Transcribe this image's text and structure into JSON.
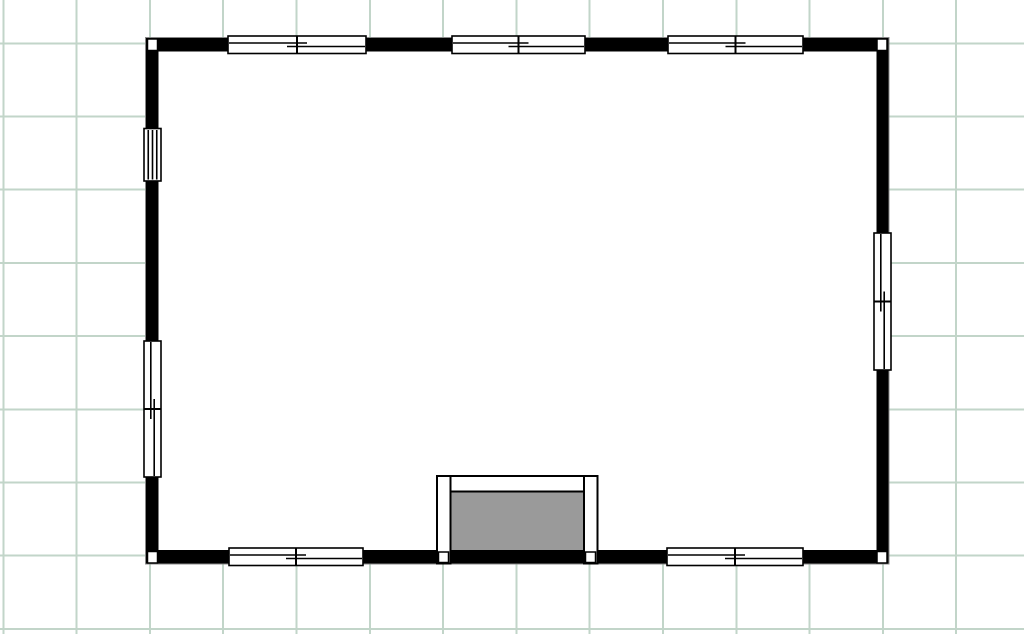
{
  "app": {
    "name": "floor-plan-editor",
    "view": "2d-plan"
  },
  "canvas": {
    "width": 1024,
    "height": 634,
    "background": "#ffffff"
  },
  "grid": {
    "visible": true,
    "color": "#c2d5c9",
    "line_width": 2,
    "spacing_x": 73.3,
    "spacing_y": 73.2,
    "offset_x": 3.3,
    "offset_y": 43.3
  },
  "colors": {
    "wall_fill": "#000000",
    "wall_outline": "#888888",
    "interior_fill": "#ffffff",
    "window_fill": "#ffffff",
    "window_stroke": "#000000",
    "fireplace_fill": "#9a9a9a",
    "fireplace_stroke": "#000000",
    "post_fill": "#ffffff",
    "post_stroke": "#000000"
  },
  "room": {
    "shape": "rectangle",
    "outer": {
      "x": 145.5,
      "y": 37.5,
      "w": 743.5,
      "h": 526.5
    },
    "inner": {
      "x": 158.5,
      "y": 51.5,
      "w": 718.0,
      "h": 498.5
    }
  },
  "corner_posts": [
    {
      "id": "corner-post-top-left",
      "x": 147.5,
      "y": 39.0,
      "w": 10,
      "h": 11.5
    },
    {
      "id": "corner-post-top-right",
      "x": 877.0,
      "y": 39.0,
      "w": 10,
      "h": 11.5
    },
    {
      "id": "corner-post-bottom-left",
      "x": 147.5,
      "y": 551.5,
      "w": 10,
      "h": 11.5
    },
    {
      "id": "corner-post-bottom-right",
      "x": 877.0,
      "y": 551.5,
      "w": 10,
      "h": 11.5
    }
  ],
  "windows": [
    {
      "id": "window-top-1",
      "wall": "top",
      "orientation": "h",
      "type": "double",
      "x": 228.0,
      "y": 36.0,
      "w": 138.0,
      "h": 17.5
    },
    {
      "id": "window-top-2",
      "wall": "top",
      "orientation": "h",
      "type": "double",
      "x": 452.0,
      "y": 36.0,
      "w": 133.0,
      "h": 17.5
    },
    {
      "id": "window-top-3",
      "wall": "top",
      "orientation": "h",
      "type": "double",
      "x": 668.0,
      "y": 36.0,
      "w": 135.0,
      "h": 17.5
    },
    {
      "id": "window-left-1",
      "wall": "left",
      "orientation": "v",
      "type": "single",
      "x": 144.0,
      "y": 128.5,
      "w": 17.0,
      "h": 52.5
    },
    {
      "id": "window-left-2",
      "wall": "left",
      "orientation": "v",
      "type": "double",
      "x": 144.0,
      "y": 341.0,
      "w": 17.0,
      "h": 136.0
    },
    {
      "id": "window-right-1",
      "wall": "right",
      "orientation": "v",
      "type": "double",
      "x": 874.0,
      "y": 233.0,
      "w": 17.0,
      "h": 137.0
    },
    {
      "id": "window-bottom-1",
      "wall": "bottom",
      "orientation": "h",
      "type": "double",
      "x": 229.0,
      "y": 548.0,
      "w": 134.0,
      "h": 17.5
    },
    {
      "id": "window-bottom-2",
      "wall": "bottom",
      "orientation": "h",
      "type": "double",
      "x": 667.0,
      "y": 548.0,
      "w": 136.0,
      "h": 17.5
    }
  ],
  "window_glyph": {
    "border_width": 1.6,
    "mullion_width": 2,
    "casement_width": 1.6,
    "casement_pos": 0.4,
    "overlap": 10,
    "single_line_fractions": [
      0.25,
      0.5,
      0.75
    ]
  },
  "fireplace": {
    "id": "fireplace",
    "firebox": {
      "x": 450.5,
      "y": 491.5,
      "w": 133.5,
      "h": 58.5
    },
    "top_band": {
      "x": 437.0,
      "y": 476.0,
      "w": 160.5,
      "h": 15.5
    },
    "left_column": {
      "x": 437.0,
      "y": 476.0,
      "w": 13.5,
      "h": 87.5
    },
    "right_column": {
      "x": 584.0,
      "y": 476.0,
      "w": 13.5,
      "h": 87.5
    },
    "band_stroke_width": 2,
    "posts": [
      {
        "id": "fireplace-post-left",
        "x": 438.5,
        "y": 552.0,
        "w": 10,
        "h": 10.5
      },
      {
        "id": "fireplace-post-right",
        "x": 585.5,
        "y": 552.0,
        "w": 10,
        "h": 10.5
      }
    ]
  }
}
